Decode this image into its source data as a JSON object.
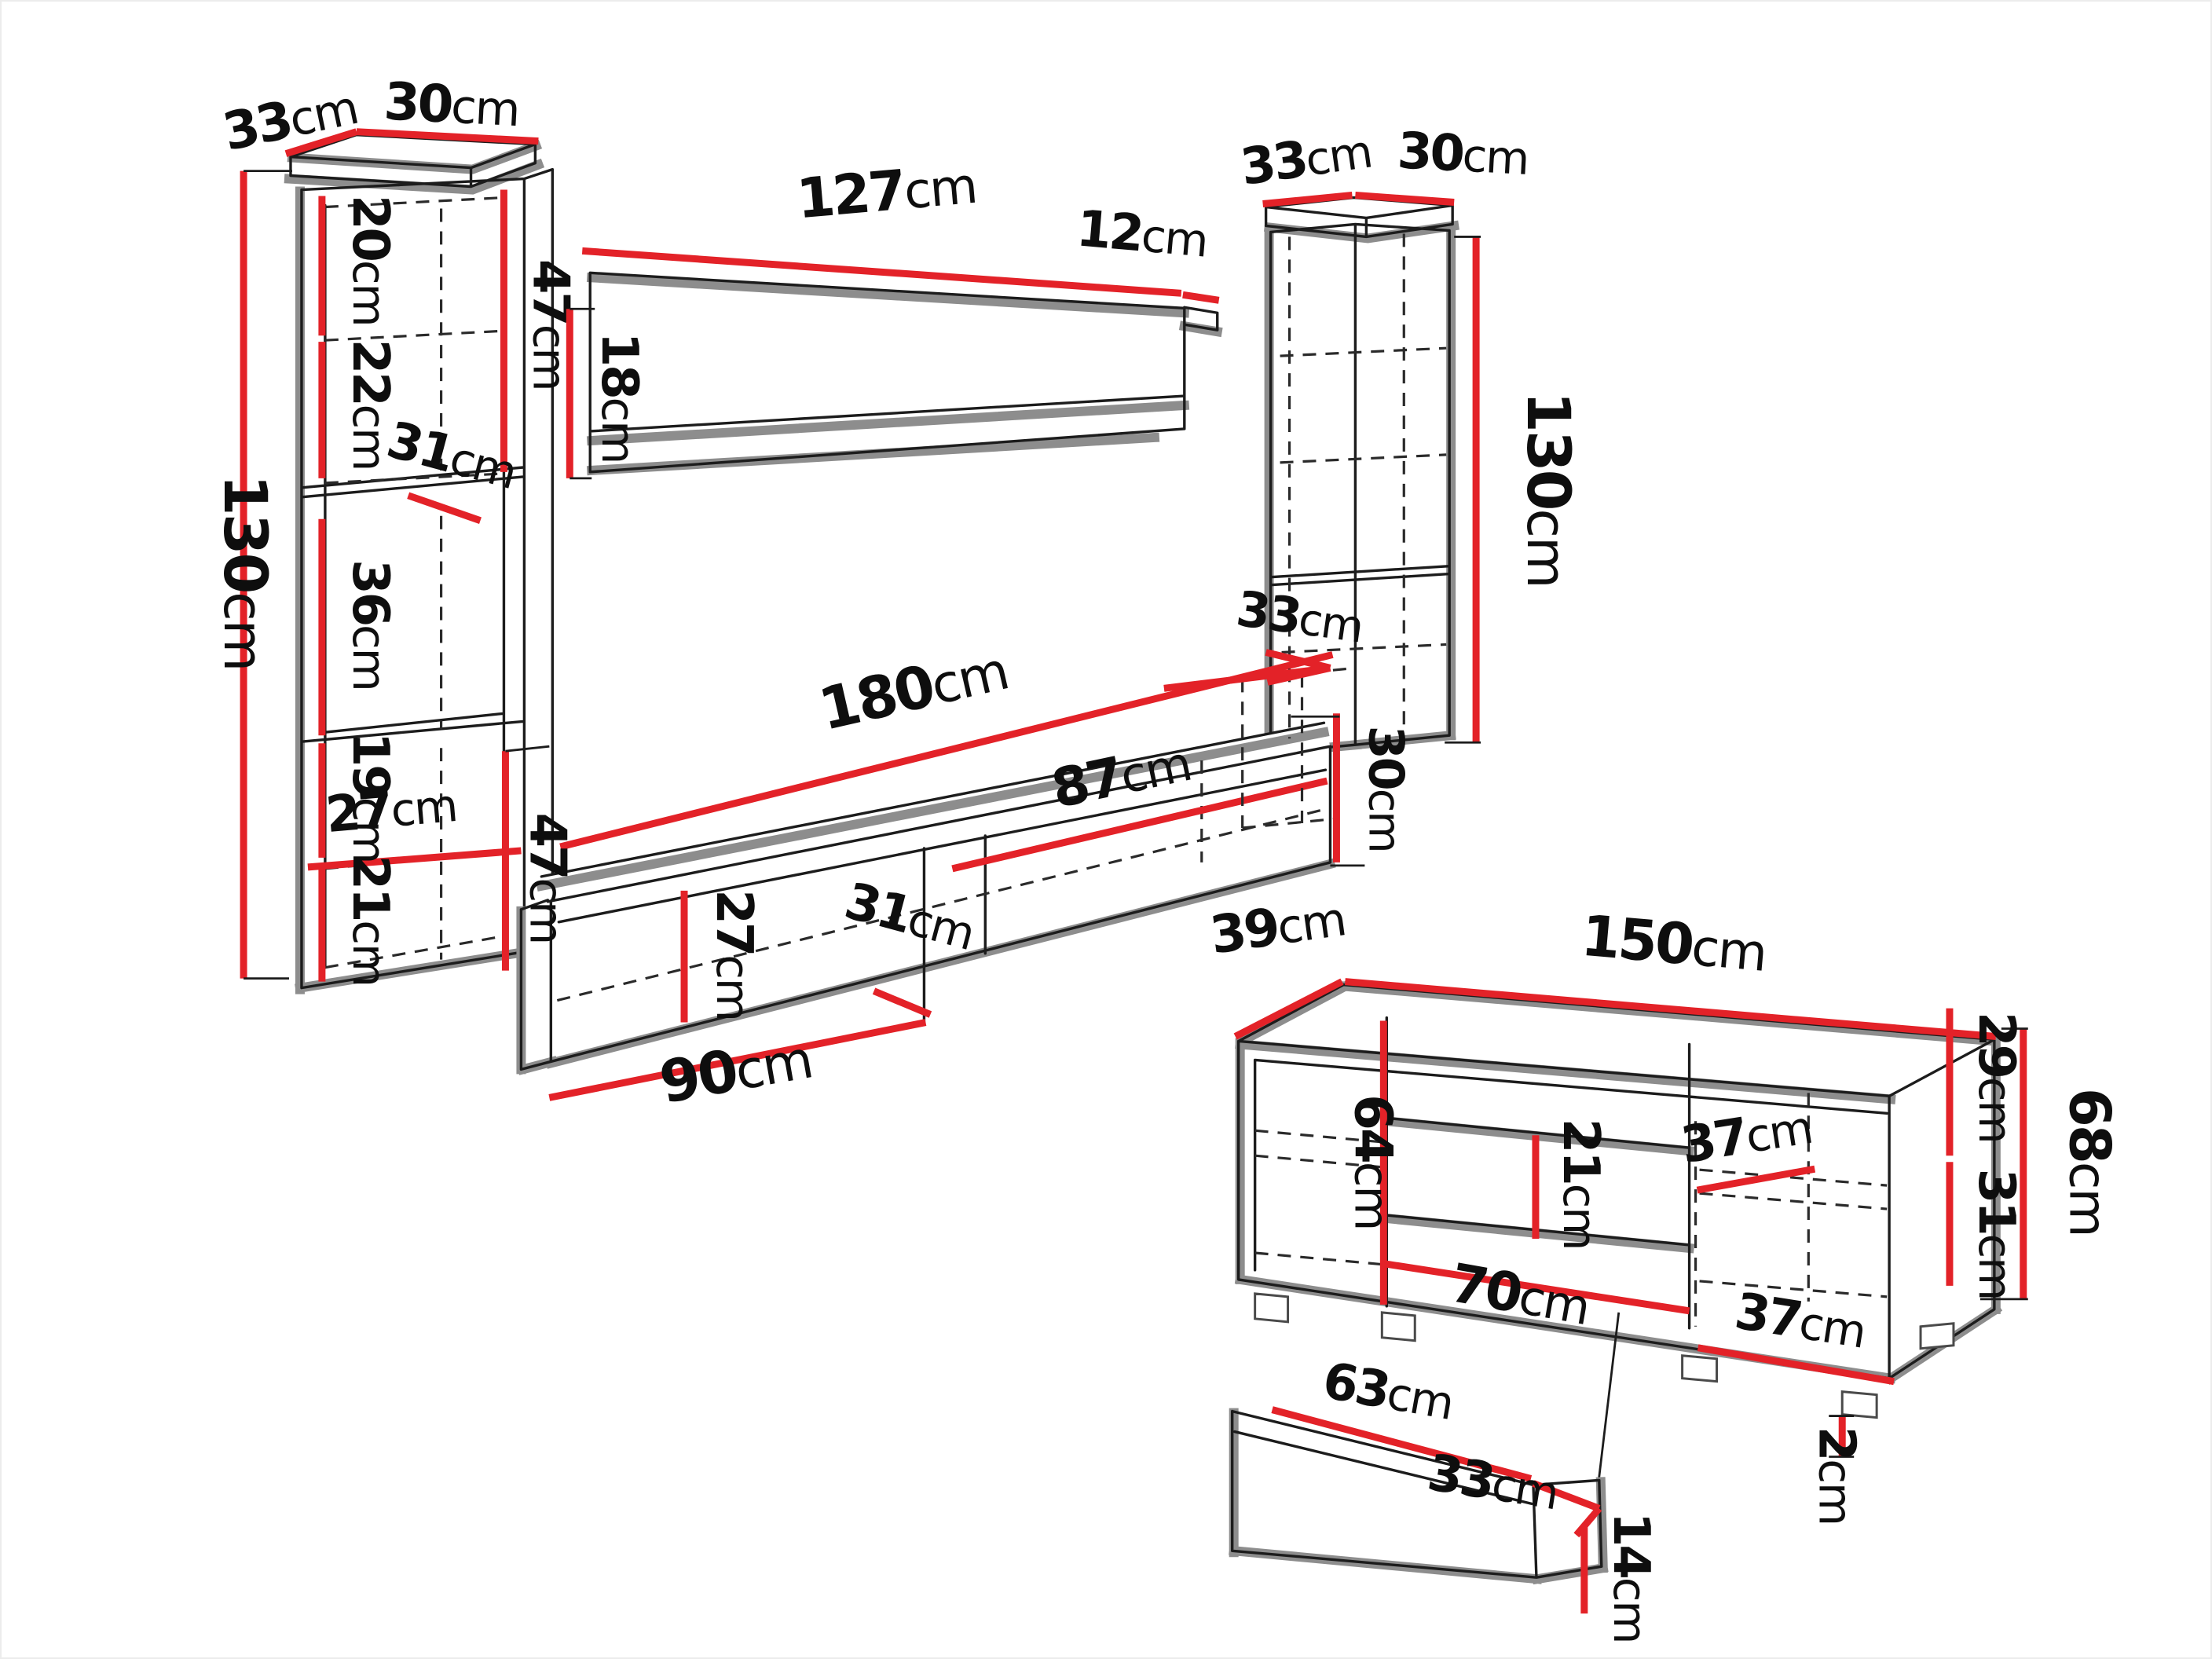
{
  "units": {
    "cm": "cm"
  },
  "left_cabinet": {
    "top_depth": "33",
    "top_width": "30",
    "height": "130",
    "section_1": "20",
    "section_2": "22",
    "shelf_depth": "31",
    "section_3": "36",
    "section_4": "19",
    "inner_width": "27",
    "section_5": "21",
    "upper_height": "47"
  },
  "wall_shelf": {
    "width": "127",
    "end_depth": "12",
    "height": "18"
  },
  "right_cabinet": {
    "top_depth": "33",
    "top_width": "30",
    "height": "130",
    "stand_depth": "33",
    "base_height": "30"
  },
  "tv_stand": {
    "width": "180",
    "right_section_width": "87",
    "inner_height": "27",
    "depth": "31",
    "left_section_width": "90",
    "height": "47"
  },
  "sideboard": {
    "depth": "39",
    "width": "150",
    "left_inner_height": "64",
    "drawer_inner_height": "21",
    "upper_shelf_depth": "37",
    "right_upper_height": "29",
    "right_lower_height": "31",
    "height": "68",
    "bottom_inner_width": "70",
    "lower_shelf_depth": "37",
    "foot_height": "2"
  },
  "drawer": {
    "width": "63",
    "depth": "33",
    "height": "14"
  }
}
